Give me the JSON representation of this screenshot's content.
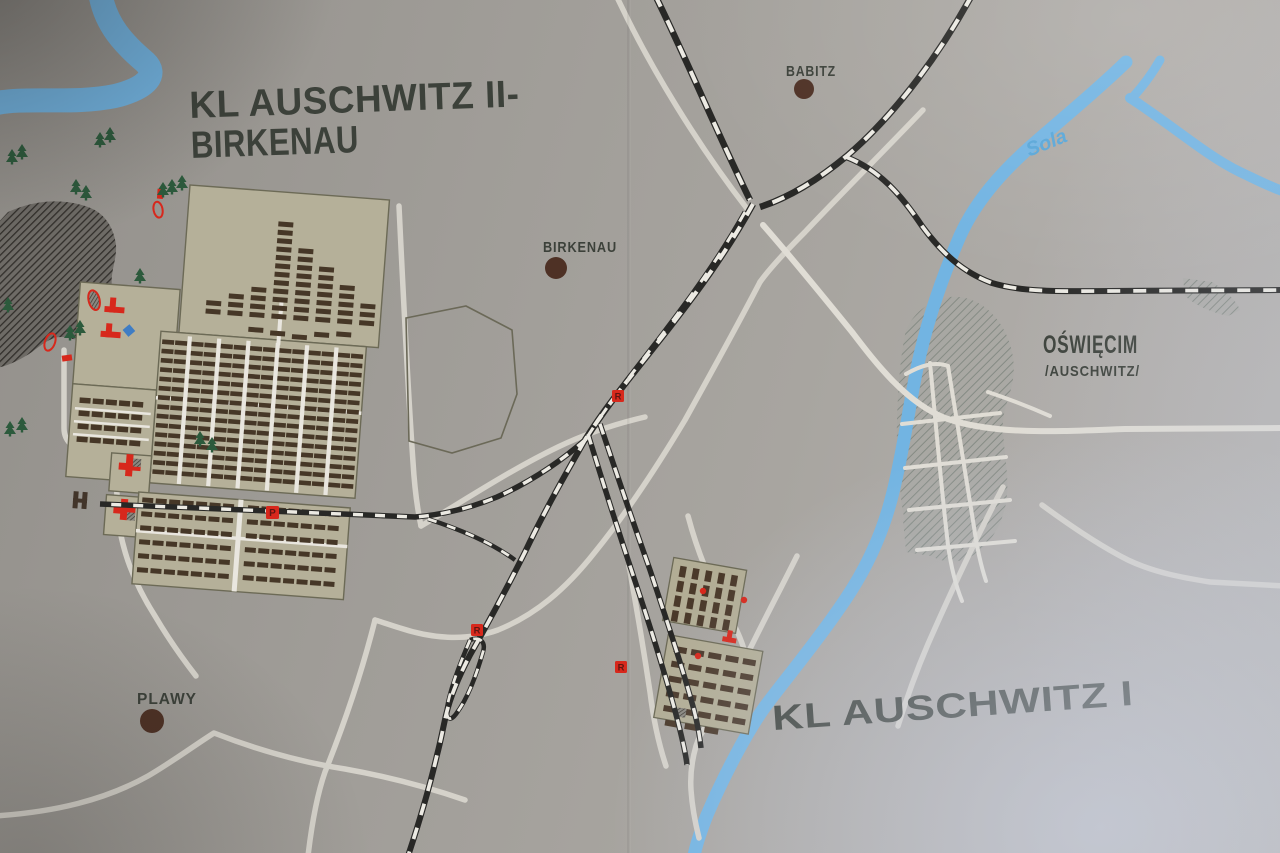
{
  "labels": {
    "title_line1": "KL AUSCHWITZ II-",
    "title_line2": "BIRKENAU",
    "auschwitz1_title": "KL AUSCHWITZ I",
    "babitz": "BABITZ",
    "birkenau_village": "BIRKENAU",
    "plawy": "PLAWY",
    "oswiecim": "OŚWIĘCIM",
    "oswiecim_alt": "/AUSCHWITZ/",
    "sola_river": "Sola"
  },
  "markers": {
    "platform": "P",
    "ramp": "R"
  },
  "colors": {
    "background_grey": "#a6a39e",
    "camp_fill": "#b5b099",
    "barrack_brown": "#463727",
    "river_blue": "#72b4e2",
    "road_white": "#d8d5cd",
    "railway_black": "#282826",
    "railway_dash": "#eceae3",
    "marker_red": "#d7281c",
    "label_dark": "#3c413a",
    "village_dot_brown": "#4e3125",
    "tree_green": "#2c5a3c",
    "glare_tint": "#ced6e9"
  }
}
